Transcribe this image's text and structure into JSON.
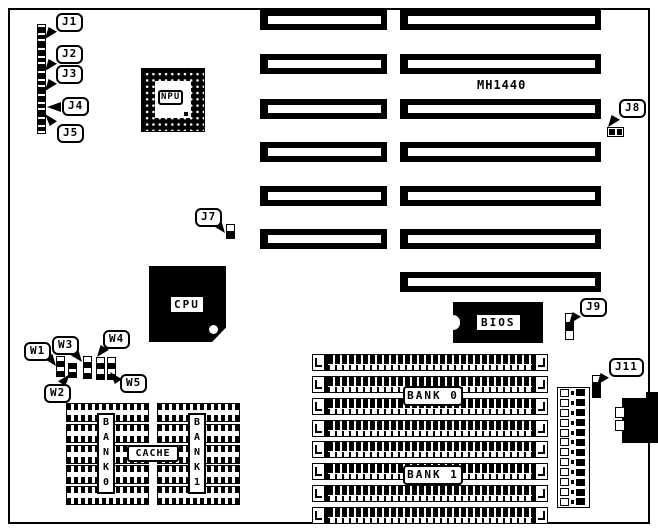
{
  "colors": {
    "ink": "#000000",
    "paper": "#ffffff"
  },
  "labels": {
    "model": "MH1440",
    "npu": "NPU",
    "cpu": "CPU",
    "bios": "BIOS",
    "cache": "CACHE",
    "bank0_vertical": "BANK0",
    "bank1_vertical": "BANK1",
    "bank0": "BANK 0",
    "bank1": "BANK 1",
    "j1": "J1",
    "j2": "J2",
    "j3": "J3",
    "j4": "J4",
    "j5": "J5",
    "j7": "J7",
    "j8": "J8",
    "j9": "J9",
    "j11": "J11",
    "w1": "W1",
    "w2": "W2",
    "w3": "W3",
    "w4": "W4",
    "w5": "W5"
  },
  "structure": {
    "expansion_slots_left_column": 6,
    "expansion_slots_right_column": 7,
    "simm_rows_bank0": 4,
    "simm_rows_bank1": 4,
    "cache_chip_rows_per_block": 5,
    "power_connector_pin_rows": 12
  }
}
